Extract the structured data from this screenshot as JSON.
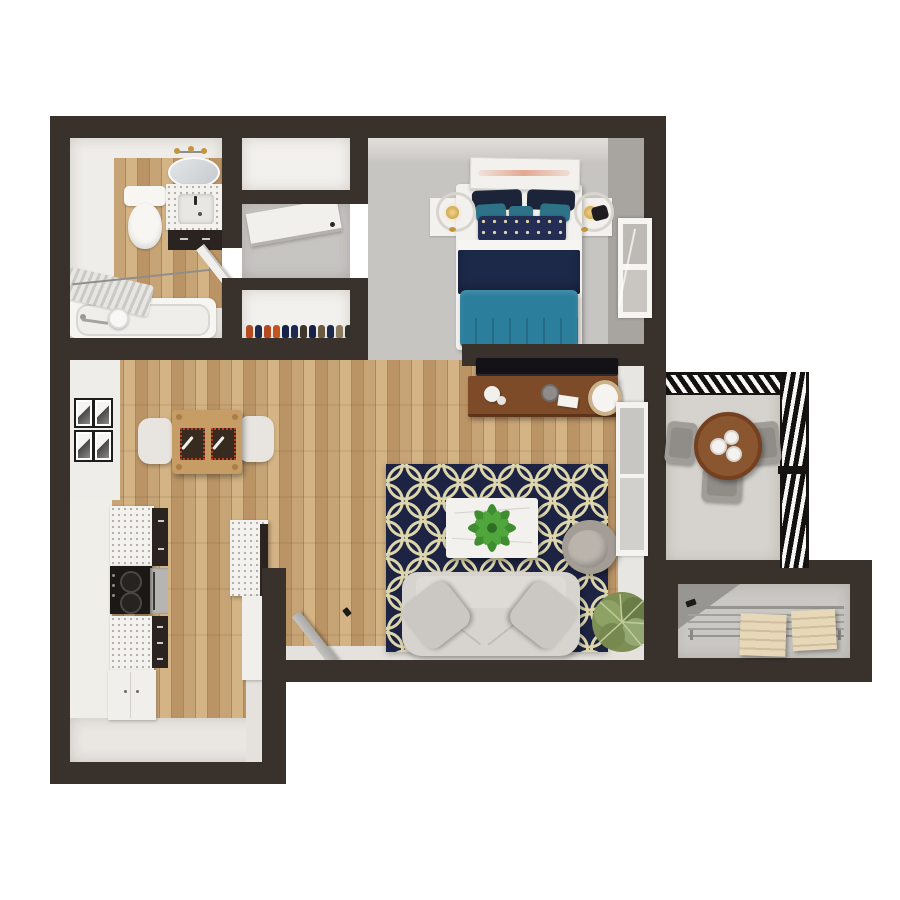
{
  "scene": {
    "type": "floorplan-3d-top-view",
    "title": "One-bedroom apartment 3D floor plan, top-down render",
    "background": "#ffffff",
    "text_labels": []
  },
  "palette": {
    "wall": "#39322c",
    "wood_a": "#c7a476",
    "wood_b": "#d4b485",
    "wood_c": "#ba9465",
    "wood_seam": "#a8895c",
    "carpet": "#c7c5c2",
    "counter": "#f4f2ee",
    "cabinet": "#2a231f",
    "tile": "#eae7e3",
    "concrete": "#d6d3ce",
    "storage_floor": "#cac8c4",
    "rug_navy": "#1d2342",
    "rug_cream": "#ddd6ac",
    "bed_navy": "#1d2949",
    "pillow_navy": "#1b2438",
    "bed_teal": "#2b7f9c",
    "pillow_teal": "#2e7288",
    "sofa_gray": "#d7d3cf",
    "cushion_gray": "#cbc7c2",
    "marble_white": "#f3f1ee",
    "console_wood": "#7d4b28",
    "dining_wood": "#c79d66",
    "balcony_table_wood": "#8a5630",
    "plant_green": "#4a9a38",
    "bush_green": "#7d8f55",
    "lamp_gold": "#c3963e",
    "art_pink": "#e3a893",
    "box_tan": "#e7d8b9",
    "oven_silver": "#b7b5b2",
    "stove_black": "#1b1815",
    "glass_gray": "#c8c6c2"
  },
  "rooms": {
    "bathroom": {
      "label": "bathroom",
      "fixtures": [
        "oval-mirror",
        "vanity-light",
        "toilet",
        "vanity-sink",
        "bathtub",
        "shower-curtain",
        "shower-rod",
        "towel-bar",
        "toilet-paper-roll",
        "bathroom-door"
      ]
    },
    "closet_top": {
      "label": "closet"
    },
    "hallway": {
      "label": "hallway",
      "fixtures": [
        "open-door"
      ]
    },
    "shoe_closet": {
      "label": "shoe closet",
      "shoe_colors": [
        "#b5491f",
        "#1d2a4e",
        "#b5491f",
        "#c2561f",
        "#16214a",
        "#1d2a4e",
        "#3d342a",
        "#16214a",
        "#6b5a41",
        "#1d2a4e",
        "#8a7a5e",
        "#2e2e2e"
      ]
    },
    "bedroom": {
      "label": "bedroom",
      "furniture": [
        "leaning-artwork",
        "bed",
        "navy-pillows",
        "teal-pillows",
        "lattice-pillow",
        "navy-blanket",
        "teal-duvet",
        "nightstand-left",
        "nightstand-right",
        "lamp-left",
        "lamp-right",
        "purse",
        "window"
      ]
    },
    "living_room": {
      "label": "living room",
      "furniture": [
        "tv",
        "media-console",
        "console-decor",
        "quatrefoil-rug",
        "coffee-table",
        "table-plant",
        "sofa",
        "throw-pillows",
        "accent-chair",
        "floor-plant",
        "patio-door",
        "leaning-door"
      ]
    },
    "dining": {
      "label": "dining area",
      "furniture": [
        "dining-table",
        "placemat-left",
        "placemat-right",
        "chair-left",
        "chair-right",
        "gallery-frames"
      ],
      "frame_count": 4
    },
    "kitchen": {
      "label": "kitchen",
      "furniture": [
        "upper-cabinet",
        "stove",
        "oven",
        "lower-cabinet",
        "base-cabinet",
        "peninsula-counter"
      ]
    },
    "balcony": {
      "label": "balcony",
      "furniture": [
        "round-table",
        "cups",
        "chair-left",
        "chair-right",
        "chair-bottom",
        "railing-top",
        "railing-right"
      ],
      "chair_count": 3
    },
    "storage": {
      "label": "storage room",
      "furniture": [
        "wire-shelf",
        "wood-box-1",
        "wood-box-2"
      ]
    }
  }
}
